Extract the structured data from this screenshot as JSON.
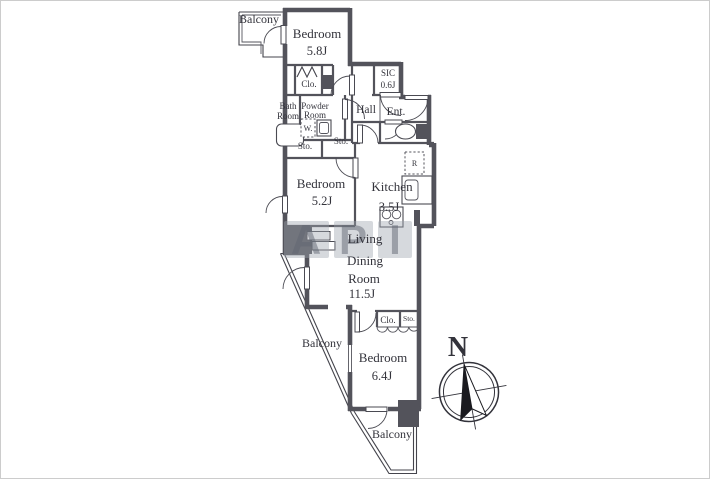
{
  "plan": {
    "balcony_top": "Balcony",
    "balcony_left": "Balcony",
    "balcony_bottom": "Balcony",
    "bedroom1": {
      "name": "Bedroom",
      "size": "5.8J"
    },
    "closet1": "Clo.",
    "bath": {
      "l1": "Bath",
      "l2": "Room"
    },
    "powder": {
      "l1": "Powder",
      "l2": "Room"
    },
    "washer": "W.",
    "hall": "Hall",
    "sic": {
      "name": "SIC",
      "size": "0.6J"
    },
    "entrance": "Ent.",
    "storage1": "Sto.",
    "storage2": "Sto.",
    "bedroom2": {
      "name": "Bedroom",
      "size": "5.2J"
    },
    "kitchen": {
      "name": "Kitchen",
      "size": "3.5J"
    },
    "refrigerator": "R",
    "living": {
      "l1": "Living",
      "l2": "Dining",
      "l3": "Room",
      "size": "11.5J"
    },
    "closet2": "Clo.",
    "storage3": "Sto.",
    "bedroom3": {
      "name": "Bedroom",
      "size": "6.4J"
    }
  },
  "compass": {
    "north": "N"
  },
  "watermark": {
    "letters": [
      "A",
      "P",
      "I"
    ]
  },
  "colors": {
    "wall": "#53535b",
    "text": "#33333b",
    "watermark": "#9aa0a8"
  }
}
